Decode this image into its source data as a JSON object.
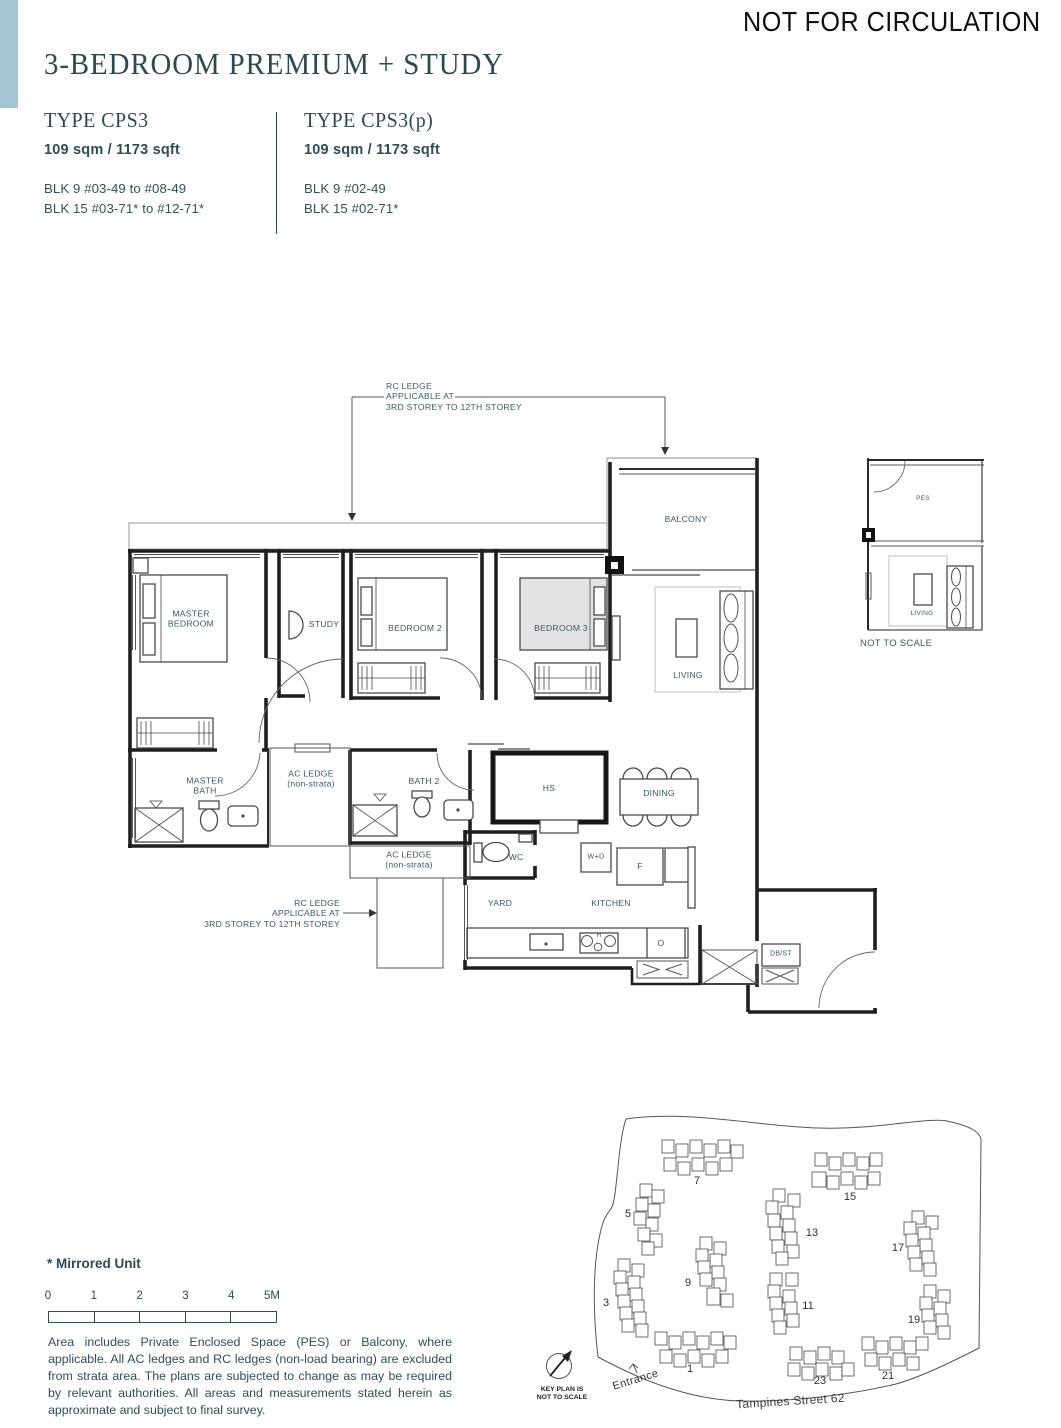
{
  "header": {
    "notice": "NOT FOR CIRCULATION",
    "title": "3-BEDROOM PREMIUM + STUDY",
    "types": [
      {
        "name": "TYPE CPS3",
        "area": "109 sqm / 1173 sqft",
        "blocks": [
          "BLK 9 #03-49 to #08-49",
          "BLK 15 #03-71* to #12-71*"
        ]
      },
      {
        "name": "TYPE CPS3(p)",
        "area": "109 sqm / 1173 sqft",
        "blocks": [
          "BLK 9 #02-49",
          "BLK 15 #02-71*"
        ]
      }
    ]
  },
  "floorplan": {
    "labels": [
      {
        "text": "MASTER\nBEDROOM",
        "x": 191,
        "y": 619
      },
      {
        "text": "STUDY",
        "x": 324,
        "y": 624
      },
      {
        "text": "BEDROOM 2",
        "x": 415,
        "y": 628
      },
      {
        "text": "BEDROOM 3",
        "x": 561,
        "y": 628
      },
      {
        "text": "BALCONY",
        "x": 686,
        "y": 519
      },
      {
        "text": "LIVING",
        "x": 688,
        "y": 675
      },
      {
        "text": "MASTER\nBATH",
        "x": 205,
        "y": 786
      },
      {
        "text": "AC LEDGE\n(non-strata)",
        "x": 311,
        "y": 779
      },
      {
        "text": "BATH 2",
        "x": 424,
        "y": 781
      },
      {
        "text": "HS",
        "x": 549,
        "y": 788
      },
      {
        "text": "DINING",
        "x": 659,
        "y": 793
      },
      {
        "text": "WC",
        "x": 516,
        "y": 857
      },
      {
        "text": "W+D",
        "x": 596,
        "y": 857,
        "size": 7.2
      },
      {
        "text": "F",
        "x": 640,
        "y": 866
      },
      {
        "text": "AC LEDGE\n(non-strata)",
        "x": 409,
        "y": 860
      },
      {
        "text": "YARD",
        "x": 500,
        "y": 903
      },
      {
        "text": "KITCHEN",
        "x": 611,
        "y": 903
      },
      {
        "text": "DB/ST",
        "x": 781,
        "y": 955,
        "size": 7
      },
      {
        "text": "O",
        "x": 661,
        "y": 943
      },
      {
        "text": "H",
        "x": 599,
        "y": 936,
        "size": 6.5
      },
      {
        "text": "RC LEDGE\nAPPLICABLE AT\n3RD STOREY TO 12TH STOREY",
        "x": 386,
        "y": 381,
        "align": "left"
      },
      {
        "text": "RC LEDGE\nAPPLICABLE AT\n3RD STOREY TO 12TH STOREY",
        "x": 340,
        "y": 898,
        "align": "right"
      }
    ]
  },
  "miniplan": {
    "labels": [
      {
        "text": "PES",
        "x": 923,
        "y": 499,
        "size": 6.5
      },
      {
        "text": "LIVING",
        "x": 922,
        "y": 614,
        "size": 6.5
      },
      {
        "text": "NOT TO SCALE",
        "x": 860,
        "y": 638,
        "size": 9.5,
        "align": "left"
      }
    ]
  },
  "keyplan": {
    "clusters": [
      {
        "label": "7",
        "x": 697,
        "y": 1181
      },
      {
        "label": "15",
        "x": 850,
        "y": 1197
      },
      {
        "label": "5",
        "x": 628,
        "y": 1214
      },
      {
        "label": "13",
        "x": 812,
        "y": 1233
      },
      {
        "label": "17",
        "x": 898,
        "y": 1248
      },
      {
        "label": "3",
        "x": 606,
        "y": 1303
      },
      {
        "label": "9",
        "x": 688,
        "y": 1283
      },
      {
        "label": "11",
        "x": 808,
        "y": 1306
      },
      {
        "label": "19",
        "x": 914,
        "y": 1320
      },
      {
        "label": "1",
        "x": 690,
        "y": 1369
      },
      {
        "label": "23",
        "x": 820,
        "y": 1381
      },
      {
        "label": "21",
        "x": 888,
        "y": 1376
      }
    ],
    "entrance_label": "Entrance",
    "street_label": "Tampines Street 62",
    "caption": "KEY PLAN IS\nNOT TO SCALE",
    "highlight_color": "#7fa3b8"
  },
  "footer": {
    "mirrored_note": "* Mirrored Unit",
    "scale_ticks": [
      "0",
      "1",
      "2",
      "3",
      "4",
      "5M"
    ],
    "disclaimer": "Area includes Private Enclosed Space (PES) or Balcony, where applicable. All AC ledges and RC ledges (non-load bearing) are excluded from strata area. The plans are subjected to change as may be required by relevant authorities. All areas and measurements stated herein as approximate and subject to final survey."
  },
  "colors": {
    "accent_bar": "#a6c3d3",
    "heading": "#2c4a52",
    "plan_text": "#3a5a68"
  }
}
